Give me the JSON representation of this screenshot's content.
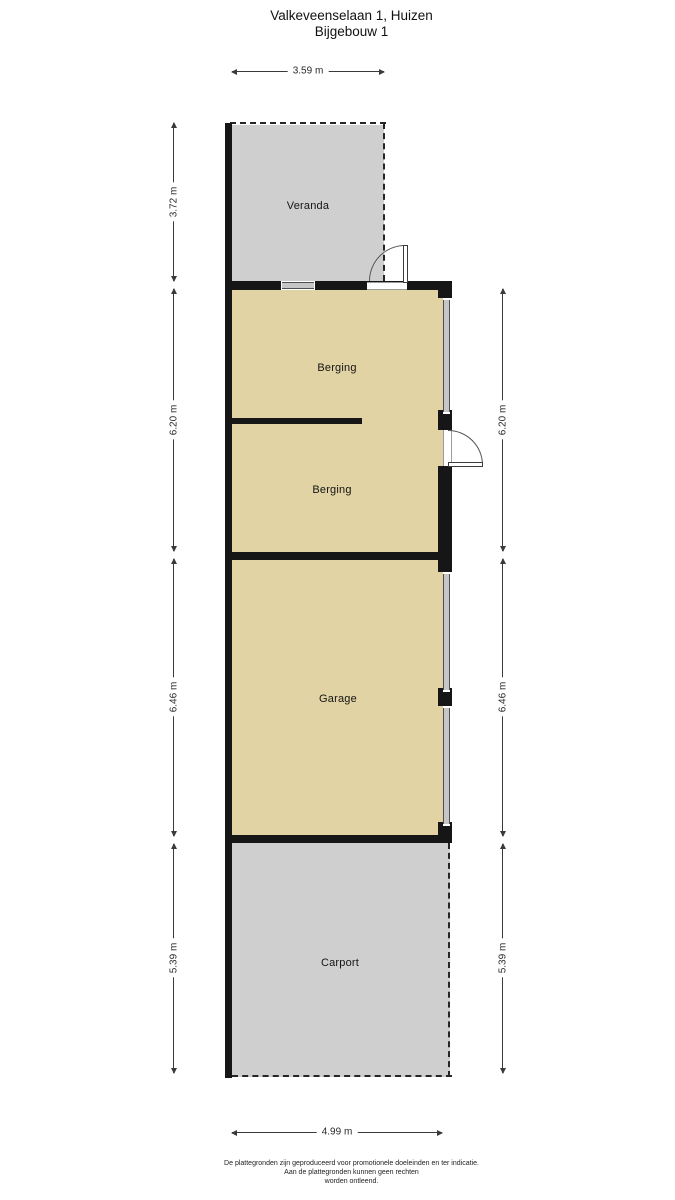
{
  "title": {
    "line1": "Valkeveenselaan 1, Huizen",
    "line2": "Bijgebouw 1"
  },
  "rooms": {
    "veranda": {
      "label": "Veranda"
    },
    "berging1": {
      "label": "Berging"
    },
    "berging2": {
      "label": "Berging"
    },
    "garage": {
      "label": "Garage"
    },
    "carport": {
      "label": "Carport"
    }
  },
  "dimensions": {
    "top": "3.59 m",
    "bottom": "4.99 m",
    "left": [
      "3.72 m",
      "6.20 m",
      "6.46 m",
      "5.39 m"
    ],
    "right": [
      "6.20 m",
      "6.46 m",
      "5.39 m"
    ]
  },
  "footer": {
    "line1": "De plattegronden zijn geproduceerd voor promotionele doeleinden en ter indicatie.",
    "line2": "Aan de plattegronden kunnen geen rechten",
    "line3": "worden ontleend."
  },
  "colors": {
    "room_fill": "#e2d3a4",
    "outdoor_fill": "#cfcfcf",
    "wall": "#161616",
    "dim_line": "#3a3a3a"
  }
}
